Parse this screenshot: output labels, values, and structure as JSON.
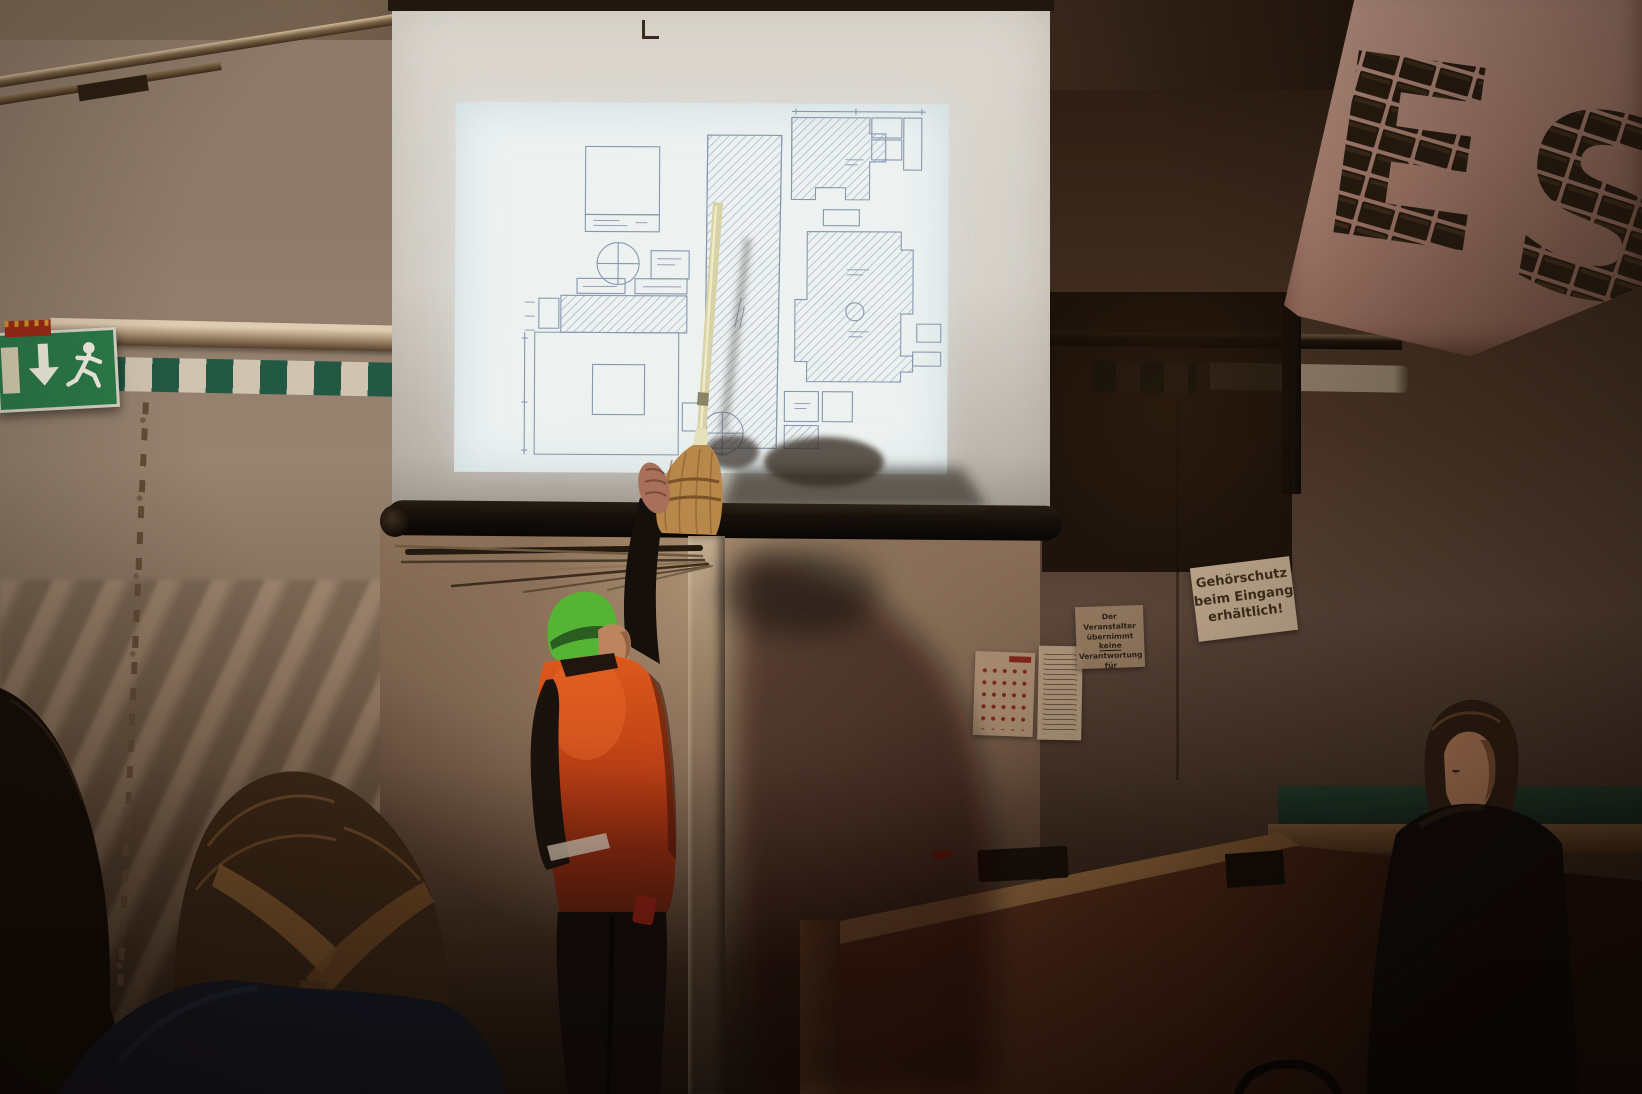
{
  "scene": {
    "alt": "Dim tent interior: presenter in orange hi-vis jacket and green beanie points a broom at a projected floor plan on a screen; audience heads in foreground",
    "surface": "projection-screen-with-floor-plan"
  },
  "signs": {
    "gehoerschutz": {
      "line1": "Gehörschutz",
      "line2": "beim Eingang",
      "line3": "erhältlich!"
    },
    "veranstalter": {
      "line1": "Der Veranstalter",
      "line2a": "übernimmt ",
      "line2b": "keine",
      "line3": "Verantwortung für",
      "line4": "Gehörschäden"
    }
  },
  "wall_letters": {
    "letter1": "E",
    "letter2": "S"
  },
  "colors": {
    "exit_green": "#2b7a49",
    "tape_green": "#225844",
    "hi_vis_orange": "#d9541c",
    "beanie_green": "#56b434",
    "projection_white": "#edf2f1",
    "plan_line_blue": "#7e8ea8",
    "broom_wood": "#d8d2a8",
    "bristle_tan": "#b8874a",
    "tarp_tan": "#93806f",
    "board_pink": "#b28a7a"
  }
}
